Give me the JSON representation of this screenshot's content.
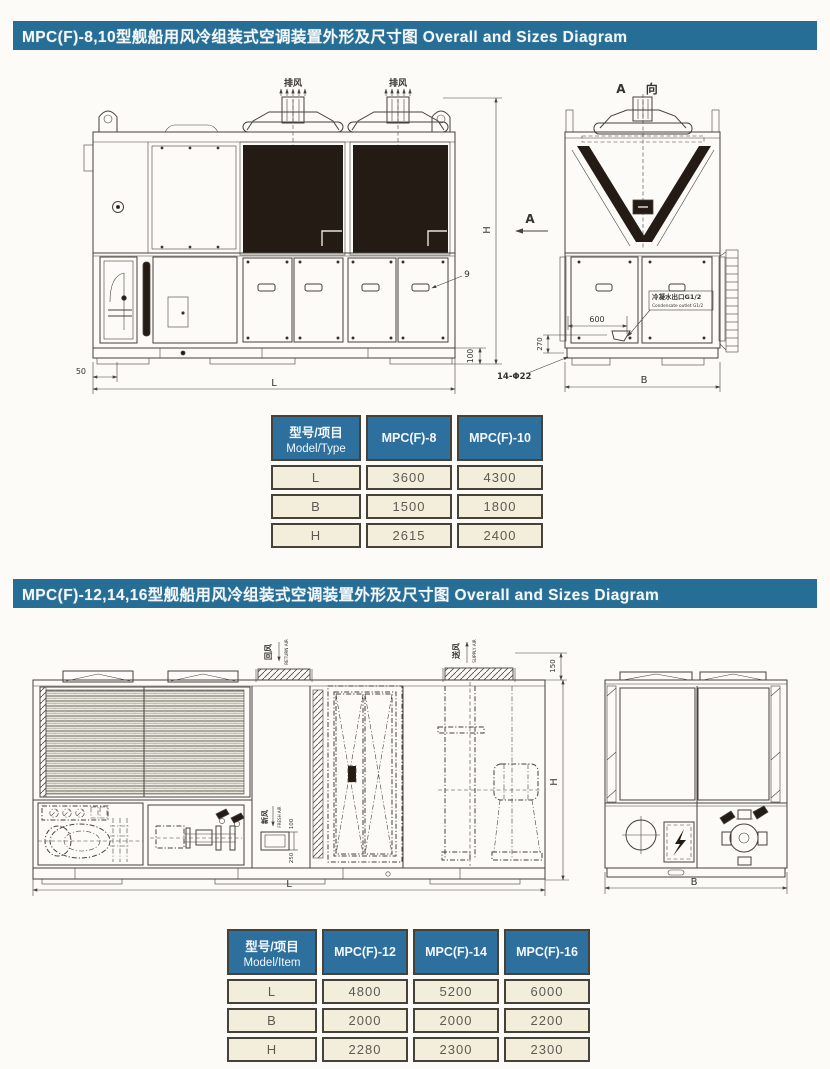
{
  "section1": {
    "title": "MPC(F)-8,10型舰船用风冷组装式空调装置外形及尺寸图  Overall and Sizes Diagram"
  },
  "section2": {
    "title": "MPC(F)-12,14,16型舰船用风冷组装式空调装置外形及尺寸图  Overall and Sizes Diagram"
  },
  "d1": {
    "exhaust": "排风",
    "view_title": "A 向",
    "view_arrow_label": "A",
    "dim_h": "H",
    "dim_l": "L",
    "dim_50": "50",
    "dim_100": "100",
    "dim_600": "600",
    "dim_270": "270",
    "dim_holes": "14-Φ22",
    "dim_b": "B",
    "callout_9": "9",
    "drain_label_cn": "冷凝水出口G1/2",
    "drain_label_en": "Condensate outlet G1/2"
  },
  "t1": {
    "header_cn": "型号/项目",
    "header_en": "Model/Type",
    "col1": "MPC(F)-8",
    "col2": "MPC(F)-10",
    "rows": [
      {
        "item": "L",
        "v": [
          "3600",
          "4300"
        ]
      },
      {
        "item": "B",
        "v": [
          "1500",
          "1800"
        ]
      },
      {
        "item": "H",
        "v": [
          "2615",
          "2400"
        ]
      }
    ]
  },
  "d2": {
    "return_cn": "回风",
    "return_en": "RETURN AIR",
    "supply_cn": "送风",
    "supply_en": "SUPPLY AIR",
    "fresh_cn": "新风",
    "fresh_en": "FRESH AIR",
    "dim_150": "150",
    "dim_250": "250",
    "dim_100": "100",
    "dim_h": "H",
    "dim_l": "L",
    "dim_b": "B"
  },
  "t2": {
    "header_cn": "型号/项目",
    "header_en": "Model/Item",
    "col1": "MPC(F)-12",
    "col2": "MPC(F)-14",
    "col3": "MPC(F)-16",
    "rows": [
      {
        "item": "L",
        "v": [
          "4800",
          "5200",
          "6000"
        ]
      },
      {
        "item": "B",
        "v": [
          "2000",
          "2000",
          "2200"
        ]
      },
      {
        "item": "H",
        "v": [
          "2280",
          "2300",
          "2300"
        ]
      }
    ]
  }
}
